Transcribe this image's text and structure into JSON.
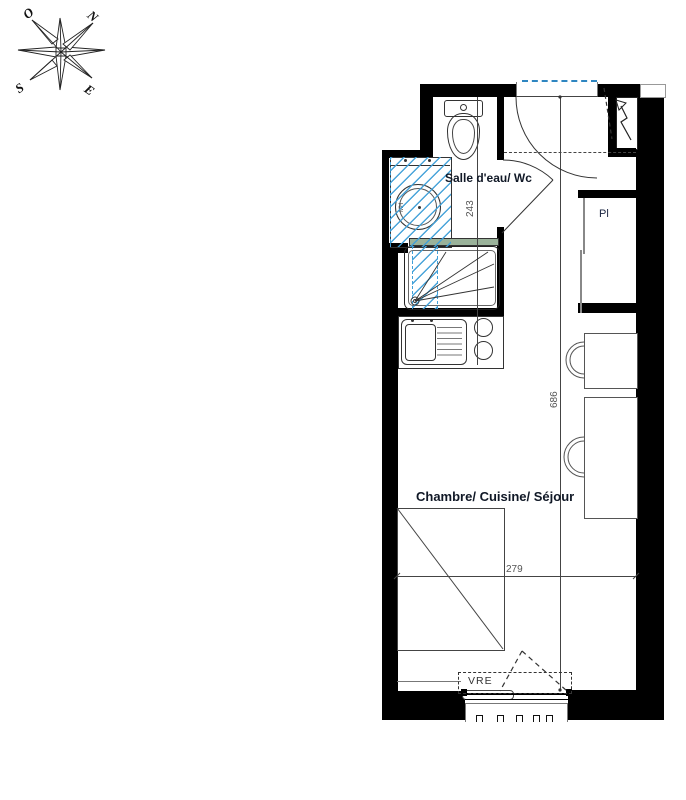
{
  "title": "Studio apartment floor plan",
  "compass": {
    "north": "N",
    "west": "O",
    "south": "S",
    "east": "E"
  },
  "rooms": {
    "bathroom": {
      "label": "Salle d'eau/ Wc"
    },
    "main": {
      "label": "Chambre/ Cuisine/ Séjour"
    }
  },
  "annotations": {
    "closet": "Pl",
    "shutter": "VRE",
    "sink_unit": "MH"
  },
  "dimensions": {
    "bathroom_depth_cm": "243",
    "apartment_length_cm": "686",
    "room_width_cm": "279"
  },
  "legend_colors": {
    "walls": "#000000",
    "renovation_hatch": "#3f9fd8",
    "glass_screen": "#9ab29a",
    "label_text": "#101826",
    "dimension_text": "#555555"
  }
}
